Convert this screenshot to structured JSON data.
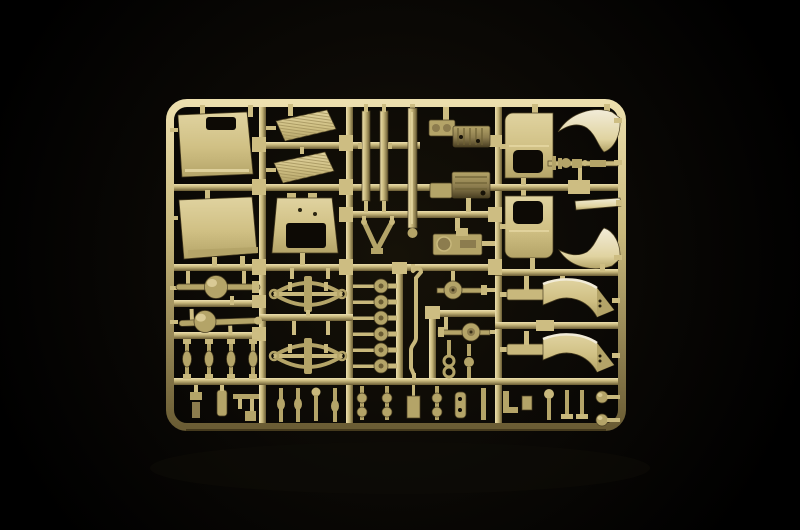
{
  "scene": {
    "type": "studio product photograph",
    "subject": "Sand-yellow injection-moulded plastic model-kit sprue (parts tree) with military truck parts, photographed on a black background",
    "background_color": "#000000",
    "palette": {
      "background": "#000000",
      "glow": "#161208",
      "base": "#c8b87c",
      "light": "#ecdfae",
      "bright": "#f2ecd8",
      "panel_light": "#e0d3a0",
      "panel_mid": "#d0c084",
      "mid": "#b4a468",
      "dark": "#8c7c4e",
      "deep": "#6a5c34",
      "shadow": "#4a3f22",
      "hole": "#0d0a05",
      "gate": "#cdbd82",
      "hatch": "#a2925c"
    },
    "sprue_frame": {
      "left": 166,
      "top": 99,
      "width": 460,
      "height": 332,
      "corner_radius": 17,
      "runner_thickness": 8
    },
    "parts_inventory": [
      {
        "name": "cab roof panel",
        "count": 1,
        "location": "top-left"
      },
      {
        "name": "cab back panel",
        "count": 1,
        "location": "mid-left"
      },
      {
        "name": "radiator grille louvre",
        "count": 2,
        "location": "top-center-left"
      },
      {
        "name": "cab firewall with opening",
        "count": 1,
        "location": "center-left"
      },
      {
        "name": "chassis side rail",
        "count": 3,
        "location": "top-center"
      },
      {
        "name": "tow-bar A-frame",
        "count": 1,
        "location": "center"
      },
      {
        "name": "engine block assembly",
        "count": 1,
        "location": "top-center-right"
      },
      {
        "name": "gearbox",
        "count": 1,
        "location": "center-right"
      },
      {
        "name": "winch assembly",
        "count": 1,
        "location": "center"
      },
      {
        "name": "cab door with window opening",
        "count": 2,
        "location": "right column"
      },
      {
        "name": "front fender",
        "count": 2,
        "location": "top-right"
      },
      {
        "name": "drive shaft",
        "count": 1,
        "location": "top-right"
      },
      {
        "name": "running board strip",
        "count": 1,
        "location": "right"
      },
      {
        "name": "rear mudguard with mounting bar",
        "count": 2,
        "location": "mid-right"
      },
      {
        "name": "axle with differential housing",
        "count": 2,
        "location": "mid-left"
      },
      {
        "name": "leaf spring",
        "count": 2,
        "location": "center-left"
      },
      {
        "name": "suspension link rod",
        "count": 4,
        "location": "lower-left"
      },
      {
        "name": "wheel hub disc",
        "count": 6,
        "location": "lower-center"
      },
      {
        "name": "brake drum with shaft",
        "count": 2,
        "location": "lower-center"
      },
      {
        "name": "exhaust pipe",
        "count": 1,
        "location": "lower-center"
      },
      {
        "name": "mirror arm with ball joint",
        "count": 2,
        "location": "lower-right"
      },
      {
        "name": "small lever / bracket",
        "count": 18,
        "location": "bottom row"
      }
    ]
  }
}
